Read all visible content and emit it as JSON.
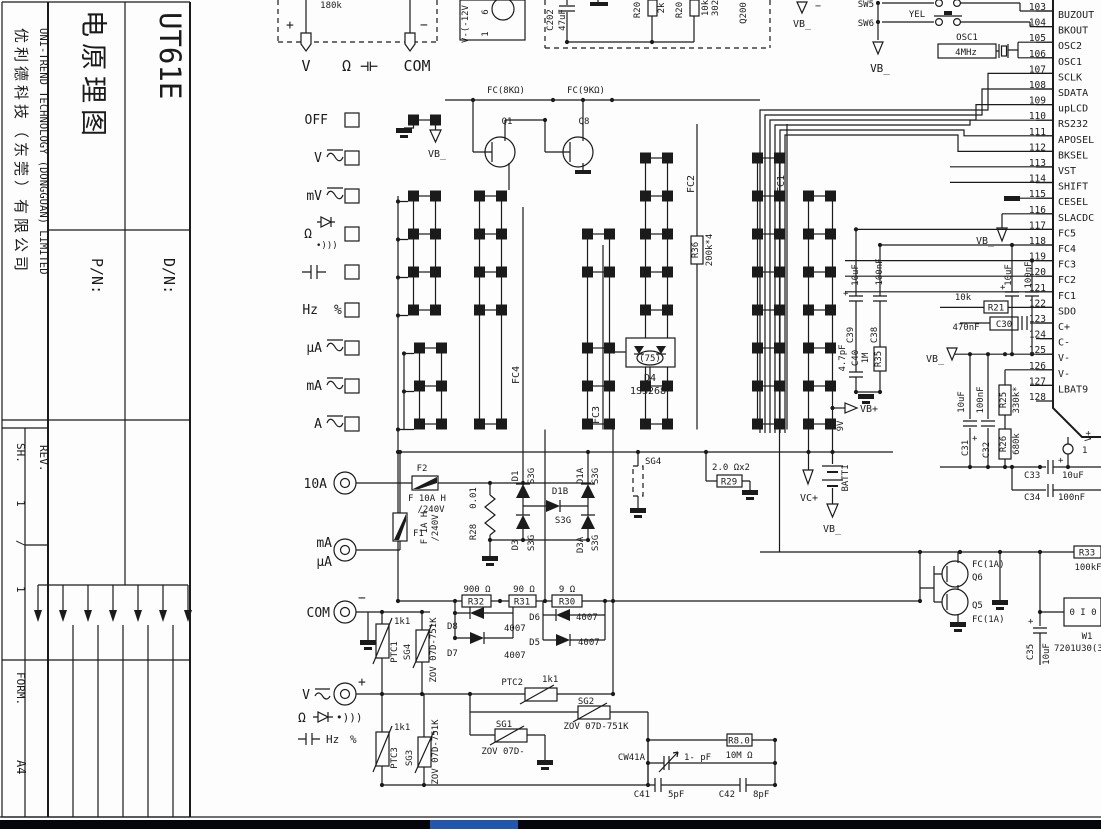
{
  "title_block": {
    "company_cn": "优利德科技（东莞）有限公司",
    "company_en": "UNI-TREND TECHNOLOGY (DONGGUAN) LIMITED",
    "doc_title": "电原理图",
    "model": "UT61E",
    "dn_label": "D/N:",
    "pn_label": "P/N:",
    "rev_label": "REV.",
    "sh_label": "SH.",
    "sheet_no": "1",
    "sheet_sep": "/",
    "sheet_total": "1",
    "form_label": "FORM.",
    "paper_size": "A4"
  },
  "probe": {
    "plus": "+",
    "minus": "−",
    "r_value": "180k",
    "v_label": "V",
    "ohm_cap_label": "Ω ⊣⊢",
    "com_label": "COM"
  },
  "psu": {
    "reg_label": "V-(-12V",
    "pin6": "6",
    "pin1": "1",
    "c202": "C202",
    "c202_value": "47uF",
    "r201": "R20",
    "r201_value": "2k",
    "r202": "R20",
    "r202_value": "10k",
    "part_302": "302",
    "q200": "Q200",
    "vb": "VB_",
    "minus": "−"
  },
  "top_switches": {
    "sw5": "SW5",
    "sw6": "SW6",
    "yel": "YEL",
    "vb": "VB_",
    "osc1": "OSC1",
    "osc1_value": "4MHz"
  },
  "rotary": {
    "rows": [
      {
        "t": "OFF"
      },
      {
        "t": "V",
        "icon": "acdc"
      },
      {
        "t": "mV",
        "icon": "acdc"
      },
      {
        "t": "Ω",
        "icon": "diode",
        "cont": "•)))"
      },
      {
        "t": "",
        "icon": "cap"
      },
      {
        "t": "Hz",
        "t2": "%"
      },
      {
        "t": "µA",
        "icon": "acdc"
      },
      {
        "t": "mA",
        "icon": "acdc"
      },
      {
        "t": "A",
        "icon": "acdc"
      }
    ],
    "vb": "VB_"
  },
  "q_top": {
    "fc8k": "FC(8KΩ)",
    "fc9k": "FC(9KΩ)",
    "q1": "Q1",
    "q8": "Q8"
  },
  "ic": {
    "pins": [
      {
        "n": "103",
        "label": "BUZOUT"
      },
      {
        "n": "104",
        "label": "BKOUT"
      },
      {
        "n": "105",
        "label": "OSC2"
      },
      {
        "n": "106",
        "label": "OSC1"
      },
      {
        "n": "107",
        "label": "SCLK"
      },
      {
        "n": "108",
        "label": "SDATA"
      },
      {
        "n": "109",
        "label": "upLCD"
      },
      {
        "n": "110",
        "label": "RS232"
      },
      {
        "n": "111",
        "label": "APOSEL"
      },
      {
        "n": "112",
        "label": "BKSEL"
      },
      {
        "n": "113",
        "label": "VST"
      },
      {
        "n": "114",
        "label": "SHIFT"
      },
      {
        "n": "115",
        "label": "CESEL"
      },
      {
        "n": "116",
        "label": "SLACDC"
      },
      {
        "n": "117",
        "label": "FC5"
      },
      {
        "n": "118",
        "label": "FC4"
      },
      {
        "n": "119",
        "label": "FC3"
      },
      {
        "n": "120",
        "label": "FC2"
      },
      {
        "n": "121",
        "label": "FC1"
      },
      {
        "n": "122",
        "label": "SDO"
      },
      {
        "n": "123",
        "label": "C+"
      },
      {
        "n": "124",
        "label": "C-"
      },
      {
        "n": "125",
        "label": "V-"
      },
      {
        "n": "126",
        "label": "V-"
      },
      {
        "n": "127",
        "label": "LBAT9"
      },
      {
        "n": "128",
        "label": ""
      }
    ],
    "vb": "VB_",
    "r21": "R21",
    "r21_value": "10k",
    "c30": "C30",
    "c30_value": "470nF",
    "cap_a": "10uF",
    "cap_b": "100nF",
    "plus": "+",
    "v_plus": "V+",
    "pin_one": "1"
  },
  "mid": {
    "fc1": "FC1",
    "fc2": "FC2",
    "fc3": "FC3",
    "fc4": "FC4",
    "r36": "R36",
    "r36_value": "200k*4",
    "d4": "D4",
    "d4_part": "1SS268",
    "d4_mark": "(75)"
  },
  "filter": {
    "c39": "C39",
    "c39_value": "10uF",
    "c38": "C38",
    "c38_value": "100nF",
    "c40": "C40",
    "c40_value": "4.7pF",
    "r35": "R35",
    "r35_value": "1M",
    "plus": "+",
    "vb_plus": "VB+"
  },
  "battery": {
    "nine_v": "9V",
    "batt1": "BATT1",
    "vc_plus": "VC+",
    "vb_minus": "VB_"
  },
  "current": {
    "jack_10a": "10A",
    "f2": "F2",
    "f2_value1": "F 10A H",
    "f2_value2": "/240V",
    "f1": "F1",
    "f1_value1": "F 1A H",
    "f1_value2": "/240V",
    "r28": "R28",
    "r28_value": "0.01",
    "jack_ma": "mA",
    "jack_ua": "µA",
    "d1": "D1",
    "d1a": "D1A",
    "d1b": "D1B",
    "d3": "D3",
    "d3a": "D3A",
    "s3g": "S3G",
    "sg4": "SG4",
    "r29": "R29",
    "r29_value": "2.0 Ωx2"
  },
  "lower_left": {
    "com": "COM",
    "minus": "−",
    "plus": "+",
    "v": "V",
    "ohm": "Ω",
    "continuity": "•)))",
    "hz": "Hz",
    "percent": "%",
    "ptc1": "PTC1",
    "ptc1_value": "1k1",
    "sg4": "SG4",
    "sg3": "SG3",
    "ptc3": "PTC3",
    "ptc3_value": "1k1",
    "zov_751": "ZOV 07D-751K"
  },
  "divider": {
    "r32": "R32",
    "r32_value": "900 Ω",
    "r31": "R31",
    "r31_value": "90 Ω",
    "r30": "R30",
    "r30_value": "9 Ω",
    "d8": "D8",
    "d7": "D7",
    "d6": "D6",
    "d5": "D5",
    "p4007": "4007"
  },
  "protection": {
    "ptc2": "PTC2",
    "ptc2_value": "1k1",
    "sg2": "SG2",
    "sg2_value": "ZOV 07D-751K",
    "sg1": "SG1",
    "sg1_value": "ZOV 07D-"
  },
  "freq": {
    "cw41a": "CW41A",
    "cw41a_value": "1- pF",
    "r8": "R8.0",
    "r8_value": "10M Ω",
    "c41": "C41",
    "c41_value": "5pF",
    "c42": "C42",
    "c42_value": "8pF"
  },
  "out": {
    "q6": "Q6",
    "q6_type": "FC(1A)",
    "q5": "Q5",
    "q5_type": "FC(1A)",
    "r33": "R33",
    "r33_value": "100kF",
    "w1": "W1",
    "w1_part": "7201U30(3",
    "w1_positions": "0 I 0",
    "c35": "C35",
    "c35_value": "10uF",
    "plus": "+"
  },
  "rail": {
    "vb": "VB_",
    "c31": "C31",
    "c31_value": "10uF",
    "c32": "C32",
    "c32_value": "100nF",
    "r25": "R25",
    "r25_value": "330k*",
    "r26": "R26",
    "r26_value": "680k",
    "c33": "C33",
    "c33_value": "10uF",
    "c34": "C34",
    "c34_value": "100nF",
    "plus": "+"
  }
}
